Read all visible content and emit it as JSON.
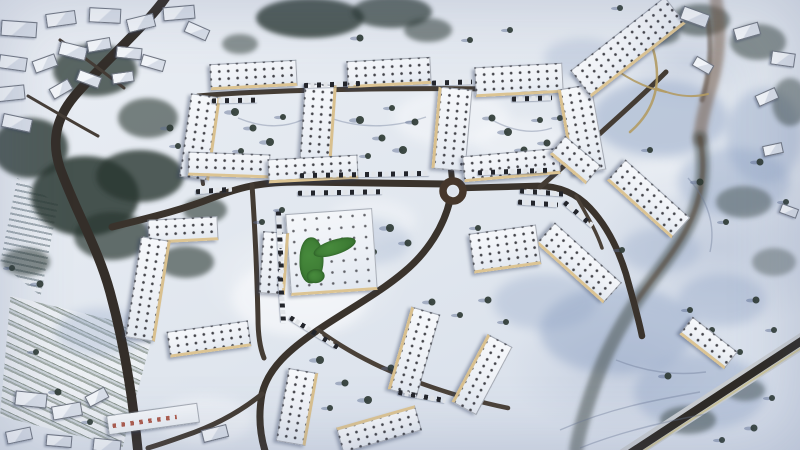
{
  "meta": {
    "subject": "aerial-winter-photo-of-snow-covered-housing-estate",
    "season": "winter-snow",
    "view": "top-down-drone"
  },
  "palette": {
    "snow_bright": "#fafbfd",
    "snow_shadow": "#8fa3c4",
    "forest": "#2c3733",
    "tree": "#2f3b35",
    "tree_shadow": "rgba(92,106,142,0.45)",
    "road_dark": "#342e29",
    "tan_path": "#b29b63",
    "roundabout_ring": "#46372b",
    "roundabout_island": "#dde3ec",
    "highway_dark": "#2e2a25",
    "highway_light": "#c9cdd1",
    "highway_edge": "#cbc49c",
    "trail": "rgba(104,118,148,0.38)",
    "lawn_green": "#478a3c"
  },
  "scene": {
    "snow_highlights": [
      [
        300,
        298,
        68,
        38,
        0.55
      ],
      [
        452,
        118,
        58,
        28,
        0.45
      ],
      [
        205,
        420,
        48,
        24,
        0.4
      ],
      [
        520,
        140,
        46,
        22,
        0.35
      ],
      [
        372,
        220,
        44,
        22,
        0.35
      ],
      [
        660,
        180,
        40,
        20,
        0.3
      ]
    ],
    "shadow_patches": [
      [
        660,
        118,
        68,
        38,
        0.45
      ],
      [
        734,
        182,
        56,
        34,
        0.4
      ],
      [
        618,
        330,
        78,
        44,
        0.45
      ],
      [
        700,
        392,
        66,
        38,
        0.4
      ],
      [
        545,
        302,
        52,
        28,
        0.32
      ],
      [
        362,
        242,
        48,
        24,
        0.25
      ],
      [
        764,
        136,
        38,
        48,
        0.38
      ],
      [
        100,
        332,
        44,
        24,
        0.3
      ],
      [
        582,
        58,
        38,
        20,
        0.28
      ],
      [
        722,
        300,
        44,
        26,
        0.35
      ],
      [
        660,
        250,
        40,
        22,
        0.3
      ]
    ],
    "tree_clusters": [
      [
        95,
        70,
        42,
        26,
        0.75
      ],
      [
        30,
        148,
        38,
        30,
        0.8
      ],
      [
        148,
        118,
        30,
        20,
        0.6
      ],
      [
        85,
        196,
        54,
        40,
        0.85
      ],
      [
        140,
        176,
        44,
        26,
        0.8
      ],
      [
        112,
        236,
        38,
        24,
        0.7
      ],
      [
        310,
        18,
        54,
        20,
        0.8
      ],
      [
        392,
        12,
        40,
        16,
        0.7
      ],
      [
        428,
        30,
        24,
        12,
        0.55
      ],
      [
        240,
        44,
        18,
        10,
        0.5
      ],
      [
        700,
        20,
        30,
        16,
        0.55
      ],
      [
        758,
        42,
        28,
        18,
        0.5
      ],
      [
        790,
        102,
        18,
        24,
        0.45
      ],
      [
        744,
        202,
        28,
        16,
        0.4
      ],
      [
        774,
        262,
        22,
        14,
        0.35
      ],
      [
        186,
        262,
        28,
        16,
        0.6
      ],
      [
        26,
        262,
        24,
        14,
        0.55
      ],
      [
        688,
        420,
        28,
        14,
        0.45
      ],
      [
        745,
        390,
        20,
        11,
        0.4
      ],
      [
        205,
        210,
        22,
        13,
        0.6
      ],
      [
        660,
        34,
        20,
        11,
        0.5
      ]
    ],
    "stream": [
      {
        "d": "M716,0 C722,34 718,66 708,96 C704,112 700,126 700,140",
        "w": 13,
        "c": "rgba(110,84,62,0.5)",
        "f": "f2"
      },
      {
        "d": "M700,138 C706,168 702,198 688,226 C674,254 652,278 636,302 C620,326 606,352 596,380 C588,402 580,426 576,450",
        "w": 14,
        "c": "rgba(62,72,66,0.5)",
        "f": "f2"
      },
      {
        "d": "M700,138 C706,168 702,198 688,226 C674,254 652,278 636,302",
        "w": 5,
        "c": "rgba(84,66,52,0.55)",
        "f": "f3"
      },
      {
        "d": "M708,20 C712,48 710,74 702,100",
        "w": 5,
        "c": "rgba(84,66,52,0.5)",
        "f": "f3"
      }
    ],
    "roads": [
      {
        "d": "M168,-6 C150,22 108,58 78,92 C58,114 50,138 60,168 C76,212 98,248 110,292 C122,336 132,388 138,452",
        "w": 9.5,
        "c": "#342e29"
      },
      {
        "d": "M446,184 L300,182 C258,182 238,188 212,198 C182,210 148,218 112,227",
        "w": 7,
        "c": "#3a332c"
      },
      {
        "d": "M252,185 C255,228 257,275 258,318 C258,336 260,348 264,358",
        "w": 5,
        "c": "#433b33"
      },
      {
        "d": "M450,200 C444,226 428,252 404,272 C378,294 344,312 318,330 C290,349 268,368 262,394 C258,416 260,436 266,454",
        "w": 7,
        "c": "#3a332c"
      },
      {
        "d": "M318,330 C348,352 380,368 412,380 C444,392 478,402 508,408",
        "w": 4.5,
        "c": "#4a4138"
      },
      {
        "d": "M262,394 C240,412 214,426 184,436 C170,441 158,445 148,448",
        "w": 5,
        "c": "#443c34"
      },
      {
        "d": "M452,180 C450,160 448,140 446,118 L443,90",
        "w": 6,
        "c": "#3a332c"
      },
      {
        "d": "M198,96 C280,89 420,87 545,90",
        "w": 5,
        "c": "#453d34"
      },
      {
        "d": "M200,96 C198,122 198,152 203,184",
        "w": 4,
        "c": "#4a423a"
      },
      {
        "d": "M462,188 L534,186 C558,185 576,193 590,208 C606,225 618,248 626,274 C632,296 638,316 642,336",
        "w": 6.5,
        "c": "#3a332c"
      },
      {
        "d": "M540,187 C562,168 584,148 606,128 C626,110 646,92 666,72",
        "w": 5,
        "c": "#443c34"
      },
      {
        "d": "M60,40 C82,56 104,72 124,88",
        "w": 3,
        "c": "#453d36"
      },
      {
        "d": "M28,96 C52,110 76,124 98,136",
        "w": 3,
        "c": "#453d36"
      },
      {
        "d": "M576,196 C586,214 596,230 602,248",
        "w": 3.5,
        "c": "#4a4138"
      }
    ],
    "tan_paths": [
      {
        "d": "M640,18 C652,40 660,64 656,88 C653,106 644,120 630,132",
        "w": 2.5
      },
      {
        "d": "M656,88 C674,96 692,98 708,94",
        "w": 2
      },
      {
        "d": "M604,60 C622,76 644,88 666,92",
        "w": 2
      }
    ],
    "highway": {
      "light": {
        "d": "M622,458 L810,336",
        "w": 16
      },
      "dark": {
        "d": "M626,456 L806,338",
        "w": 8
      },
      "edge": {
        "d": "M631,459 L809,343",
        "w": 2
      }
    },
    "roundabout": {
      "cx": 453,
      "cy": 191,
      "r": 10,
      "ring_w": 7.5,
      "island_r": 4.5
    },
    "trails": [
      "M560,430 C610,408 655,400 700,392",
      "M580,448 C620,432 662,422 706,414",
      "M330,118 C365,130 396,127 426,117",
      "M492,120 C514,132 534,134 552,128",
      "M688,178 C708,200 716,226 710,252",
      "M616,360 C646,372 676,376 706,372",
      "M238,118 C262,128 284,128 302,120"
    ],
    "trees": [
      [
        235,
        112,
        4
      ],
      [
        253,
        128,
        3.5
      ],
      [
        270,
        142,
        4
      ],
      [
        241,
        151,
        3
      ],
      [
        283,
        117,
        3
      ],
      [
        360,
        120,
        4
      ],
      [
        382,
        138,
        3.5
      ],
      [
        403,
        150,
        4
      ],
      [
        368,
        156,
        3
      ],
      [
        415,
        122,
        3.5
      ],
      [
        392,
        108,
        3
      ],
      [
        492,
        118,
        3.5
      ],
      [
        508,
        132,
        4
      ],
      [
        524,
        150,
        3.5
      ],
      [
        540,
        120,
        3
      ],
      [
        500,
        158,
        3
      ],
      [
        547,
        143,
        3.5
      ],
      [
        390,
        228,
        4
      ],
      [
        408,
        243,
        3.5
      ],
      [
        374,
        252,
        3
      ],
      [
        320,
        360,
        4
      ],
      [
        345,
        383,
        3.5
      ],
      [
        368,
        400,
        4
      ],
      [
        330,
        408,
        3
      ],
      [
        391,
        368,
        3.5
      ],
      [
        312,
        386,
        3
      ],
      [
        432,
        302,
        3.5
      ],
      [
        460,
        315,
        3
      ],
      [
        488,
        300,
        3.5
      ],
      [
        506,
        322,
        3
      ],
      [
        700,
        182,
        3.5
      ],
      [
        726,
        222,
        3
      ],
      [
        756,
        300,
        3.5
      ],
      [
        712,
        330,
        3
      ],
      [
        668,
        376,
        3.5
      ],
      [
        740,
        352,
        3
      ],
      [
        774,
        330,
        3
      ],
      [
        786,
        202,
        3
      ],
      [
        760,
        162,
        3.5
      ],
      [
        690,
        310,
        3
      ],
      [
        722,
        440,
        3
      ],
      [
        772,
        398,
        3
      ],
      [
        754,
        428,
        3.5
      ],
      [
        170,
        128,
        3.5
      ],
      [
        178,
        146,
        3
      ],
      [
        12,
        268,
        3
      ],
      [
        40,
        284,
        3.5
      ],
      [
        36,
        352,
        3
      ],
      [
        58,
        392,
        3.5
      ],
      [
        90,
        422,
        3
      ],
      [
        478,
        228,
        3
      ],
      [
        496,
        242,
        3
      ],
      [
        560,
        118,
        3
      ],
      [
        570,
        96,
        3.5
      ],
      [
        650,
        150,
        3
      ],
      [
        622,
        250,
        3
      ],
      [
        600,
        290,
        3
      ],
      [
        360,
        38,
        3.5
      ],
      [
        470,
        40,
        3
      ],
      [
        510,
        30,
        3
      ],
      [
        620,
        8,
        3
      ],
      [
        282,
        210,
        3
      ],
      [
        262,
        222,
        3
      ]
    ],
    "car_rows": [
      [
        300,
        172,
        130,
        -1
      ],
      [
        478,
        169,
        70,
        -2
      ],
      [
        298,
        190,
        85,
        -1
      ],
      [
        304,
        82,
        56,
        -2
      ],
      [
        432,
        80,
        40,
        -2
      ],
      [
        212,
        98,
        46,
        -1
      ],
      [
        512,
        96,
        40,
        -2
      ],
      [
        249,
        240,
        62,
        87
      ],
      [
        259,
        298,
        46,
        86
      ],
      [
        286,
        330,
        56,
        32
      ],
      [
        520,
        190,
        44,
        4
      ],
      [
        518,
        201,
        40,
        4
      ],
      [
        560,
        212,
        38,
        40
      ],
      [
        398,
        394,
        48,
        10
      ],
      [
        196,
        188,
        36,
        -4
      ]
    ],
    "buildings": [
      [
        252,
        73,
        85,
        22,
        -3,
        "b",
        "s"
      ],
      [
        388,
        70,
        82,
        23,
        -3,
        "b",
        "s"
      ],
      [
        518,
        78,
        86,
        26,
        -3,
        "b",
        "s"
      ],
      [
        198,
        136,
        26,
        82,
        8,
        "r",
        "s"
      ],
      [
        316,
        124,
        28,
        80,
        4,
        "r",
        "s"
      ],
      [
        450,
        128,
        30,
        80,
        5,
        "l",
        "s"
      ],
      [
        580,
        128,
        30,
        85,
        -10,
        "l",
        "s"
      ],
      [
        228,
        163,
        80,
        20,
        2,
        "b",
        "s"
      ],
      [
        312,
        167,
        88,
        20,
        -3,
        "b",
        "s"
      ],
      [
        510,
        163,
        95,
        22,
        -5,
        "b",
        "s"
      ],
      [
        627,
        45,
        118,
        30,
        -38,
        "b",
        "s"
      ],
      [
        574,
        158,
        45,
        20,
        40,
        "b",
        "s"
      ],
      [
        647,
        197,
        85,
        24,
        42,
        "b",
        "s"
      ],
      [
        578,
        261,
        88,
        24,
        42,
        "b",
        "s"
      ],
      [
        707,
        341,
        55,
        18,
        38,
        "b",
        "s"
      ],
      [
        504,
        247,
        66,
        36,
        -8,
        "b",
        "s"
      ],
      [
        330,
        250,
        85,
        78,
        -4,
        "b",
        "c"
      ],
      [
        272,
        262,
        22,
        60,
        4,
        "r",
        "s"
      ],
      [
        182,
        228,
        68,
        20,
        -3,
        "b",
        "s"
      ],
      [
        146,
        288,
        26,
        100,
        9,
        "r",
        "s"
      ],
      [
        208,
        337,
        80,
        22,
        -8,
        "b",
        "s"
      ],
      [
        295,
        406,
        26,
        72,
        10,
        "r",
        "s"
      ],
      [
        412,
        351,
        26,
        84,
        16,
        "l",
        "s"
      ],
      [
        378,
        427,
        80,
        22,
        -16,
        "t",
        "s"
      ],
      [
        480,
        373,
        24,
        75,
        28,
        "l",
        "s"
      ],
      [
        18,
        28,
        34,
        14,
        4,
        "n",
        "h"
      ],
      [
        60,
        18,
        28,
        12,
        -8,
        "n",
        "h"
      ],
      [
        104,
        14,
        30,
        13,
        3,
        "n",
        "h"
      ],
      [
        140,
        22,
        26,
        12,
        -14,
        "n",
        "h"
      ],
      [
        178,
        12,
        30,
        12,
        -5,
        "n",
        "h"
      ],
      [
        12,
        62,
        26,
        12,
        8,
        "n",
        "h"
      ],
      [
        8,
        92,
        30,
        13,
        -6,
        "n",
        "h"
      ],
      [
        16,
        122,
        28,
        12,
        12,
        "n",
        "h"
      ],
      [
        44,
        62,
        22,
        11,
        -20,
        "n",
        "h"
      ],
      [
        72,
        50,
        26,
        12,
        14,
        "n",
        "h"
      ],
      [
        98,
        44,
        22,
        10,
        -10,
        "n",
        "h"
      ],
      [
        128,
        52,
        24,
        10,
        6,
        "n",
        "h"
      ],
      [
        60,
        88,
        20,
        10,
        -30,
        "n",
        "h"
      ],
      [
        88,
        78,
        22,
        10,
        20,
        "n",
        "h"
      ],
      [
        122,
        76,
        20,
        9,
        -8,
        "n",
        "h"
      ],
      [
        152,
        62,
        22,
        10,
        16,
        "n",
        "h"
      ],
      [
        196,
        30,
        22,
        10,
        24,
        "n",
        "h"
      ],
      [
        30,
        398,
        30,
        13,
        6,
        "n",
        "h"
      ],
      [
        66,
        410,
        28,
        12,
        -10,
        "n",
        "h"
      ],
      [
        18,
        434,
        24,
        11,
        -12,
        "n",
        "h"
      ],
      [
        58,
        440,
        24,
        10,
        5,
        "n",
        "h"
      ],
      [
        106,
        444,
        26,
        11,
        6,
        "n",
        "h"
      ],
      [
        214,
        432,
        24,
        11,
        -14,
        "n",
        "h"
      ],
      [
        96,
        396,
        20,
        10,
        -28,
        "n",
        "h"
      ],
      [
        152,
        418,
        90,
        18,
        -8,
        "n",
        "m"
      ],
      [
        694,
        16,
        26,
        12,
        20,
        "n",
        "h"
      ],
      [
        746,
        30,
        24,
        11,
        -16,
        "n",
        "h"
      ],
      [
        782,
        58,
        22,
        12,
        8,
        "n",
        "h"
      ],
      [
        766,
        96,
        20,
        10,
        -24,
        "n",
        "h"
      ],
      [
        702,
        64,
        18,
        9,
        30,
        "n",
        "h"
      ],
      [
        788,
        210,
        16,
        8,
        20,
        "n",
        "h"
      ],
      [
        772,
        148,
        18,
        9,
        -12,
        "n",
        "h"
      ]
    ],
    "green_courtyard": {
      "blobs": [
        {
          "l": 10,
          "t": 24,
          "w": 24,
          "h": 46,
          "rot": 6,
          "br": "45% 55% 50% 50%"
        },
        {
          "l": 24,
          "t": 28,
          "w": 44,
          "h": 15,
          "rot": -14,
          "br": "50%"
        },
        {
          "l": 16,
          "t": 56,
          "w": 18,
          "h": 14,
          "rot": 0,
          "br": "50%"
        }
      ]
    }
  }
}
